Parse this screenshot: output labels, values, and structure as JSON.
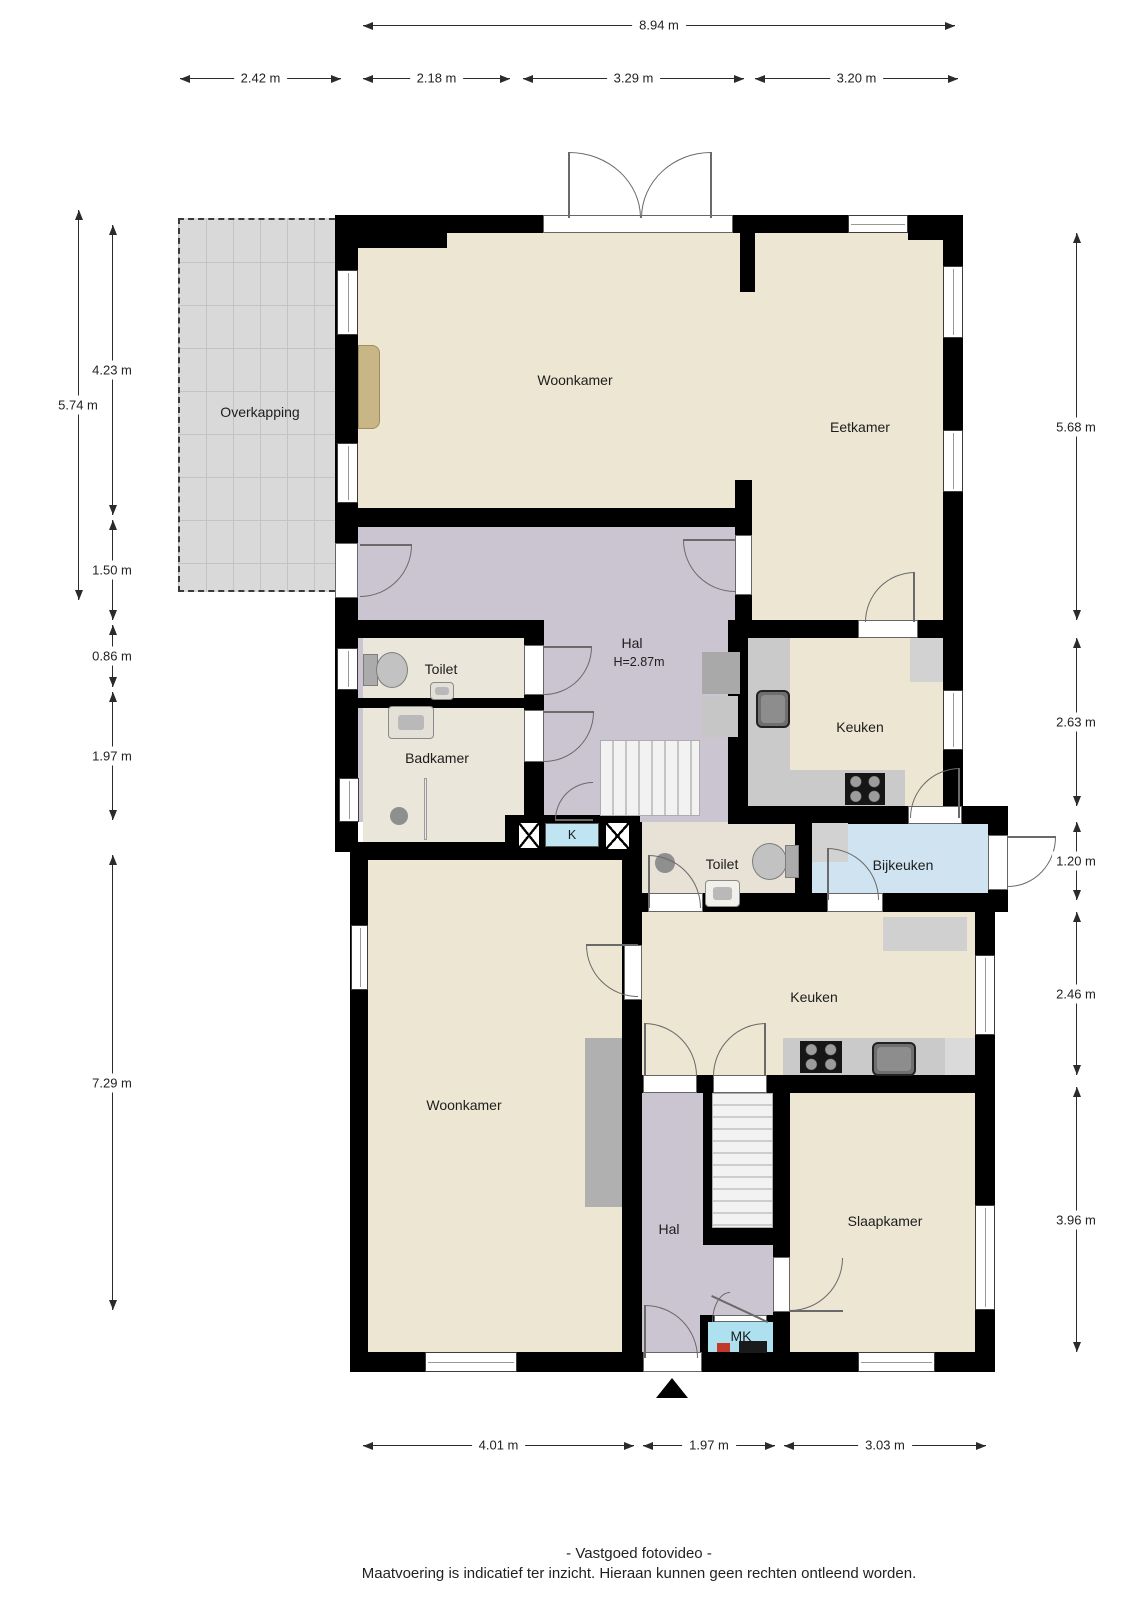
{
  "rooms": {
    "overkapping": {
      "label": "Overkapping"
    },
    "woonkamer_top": {
      "label": "Woonkamer"
    },
    "eetkamer": {
      "label": "Eetkamer"
    },
    "hal_top": {
      "label": "Hal",
      "height_note": "H=2.87m"
    },
    "toilet_top": {
      "label": "Toilet"
    },
    "badkamer": {
      "label": "Badkamer"
    },
    "keuken_top": {
      "label": "Keuken"
    },
    "kast_k": {
      "label": "K"
    },
    "toilet_mid": {
      "label": "Toilet"
    },
    "bijkeuken": {
      "label": "Bijkeuken"
    },
    "keuken_bottom": {
      "label": "Keuken"
    },
    "woonkamer_bottom": {
      "label": "Woonkamer"
    },
    "hal_bottom": {
      "label": "Hal"
    },
    "slaapkamer": {
      "label": "Slaapkamer"
    },
    "meterkast": {
      "label": "MK"
    }
  },
  "dimensions": {
    "top_total": "8.94 m",
    "top_segments": [
      "2.42 m",
      "2.18 m",
      "3.29 m",
      "3.20 m"
    ],
    "left": [
      "5.74 m",
      "4.23 m",
      "1.50 m",
      "0.86 m",
      "1.97 m",
      "7.29 m"
    ],
    "right": [
      "5.68 m",
      "2.63 m",
      "1.20 m",
      "2.46 m",
      "3.96 m"
    ],
    "bottom": [
      "4.01 m",
      "1.97 m",
      "3.03 m"
    ]
  },
  "footer": {
    "line1": "- Vastgoed fotovideo -",
    "line2": "Maatvoering is indicatief ter inzicht. Hieraan kunnen geen rechten ontleend worden."
  },
  "colors": {
    "wall": "#000000",
    "floor_living": "#ece6d2",
    "floor_hal": "#cbc5d2",
    "floor_bath": "#eae6da",
    "floor_toilet_mid": "#e7e2d5",
    "bijkeuken_blue": "#cfe3f0",
    "closet_k": "#bfe4f2",
    "closet_mk": "#aee1ef",
    "overkapping_gray": "#d9d9d9",
    "counter_gray": "#cacaca",
    "dimension_text": "#222222"
  }
}
